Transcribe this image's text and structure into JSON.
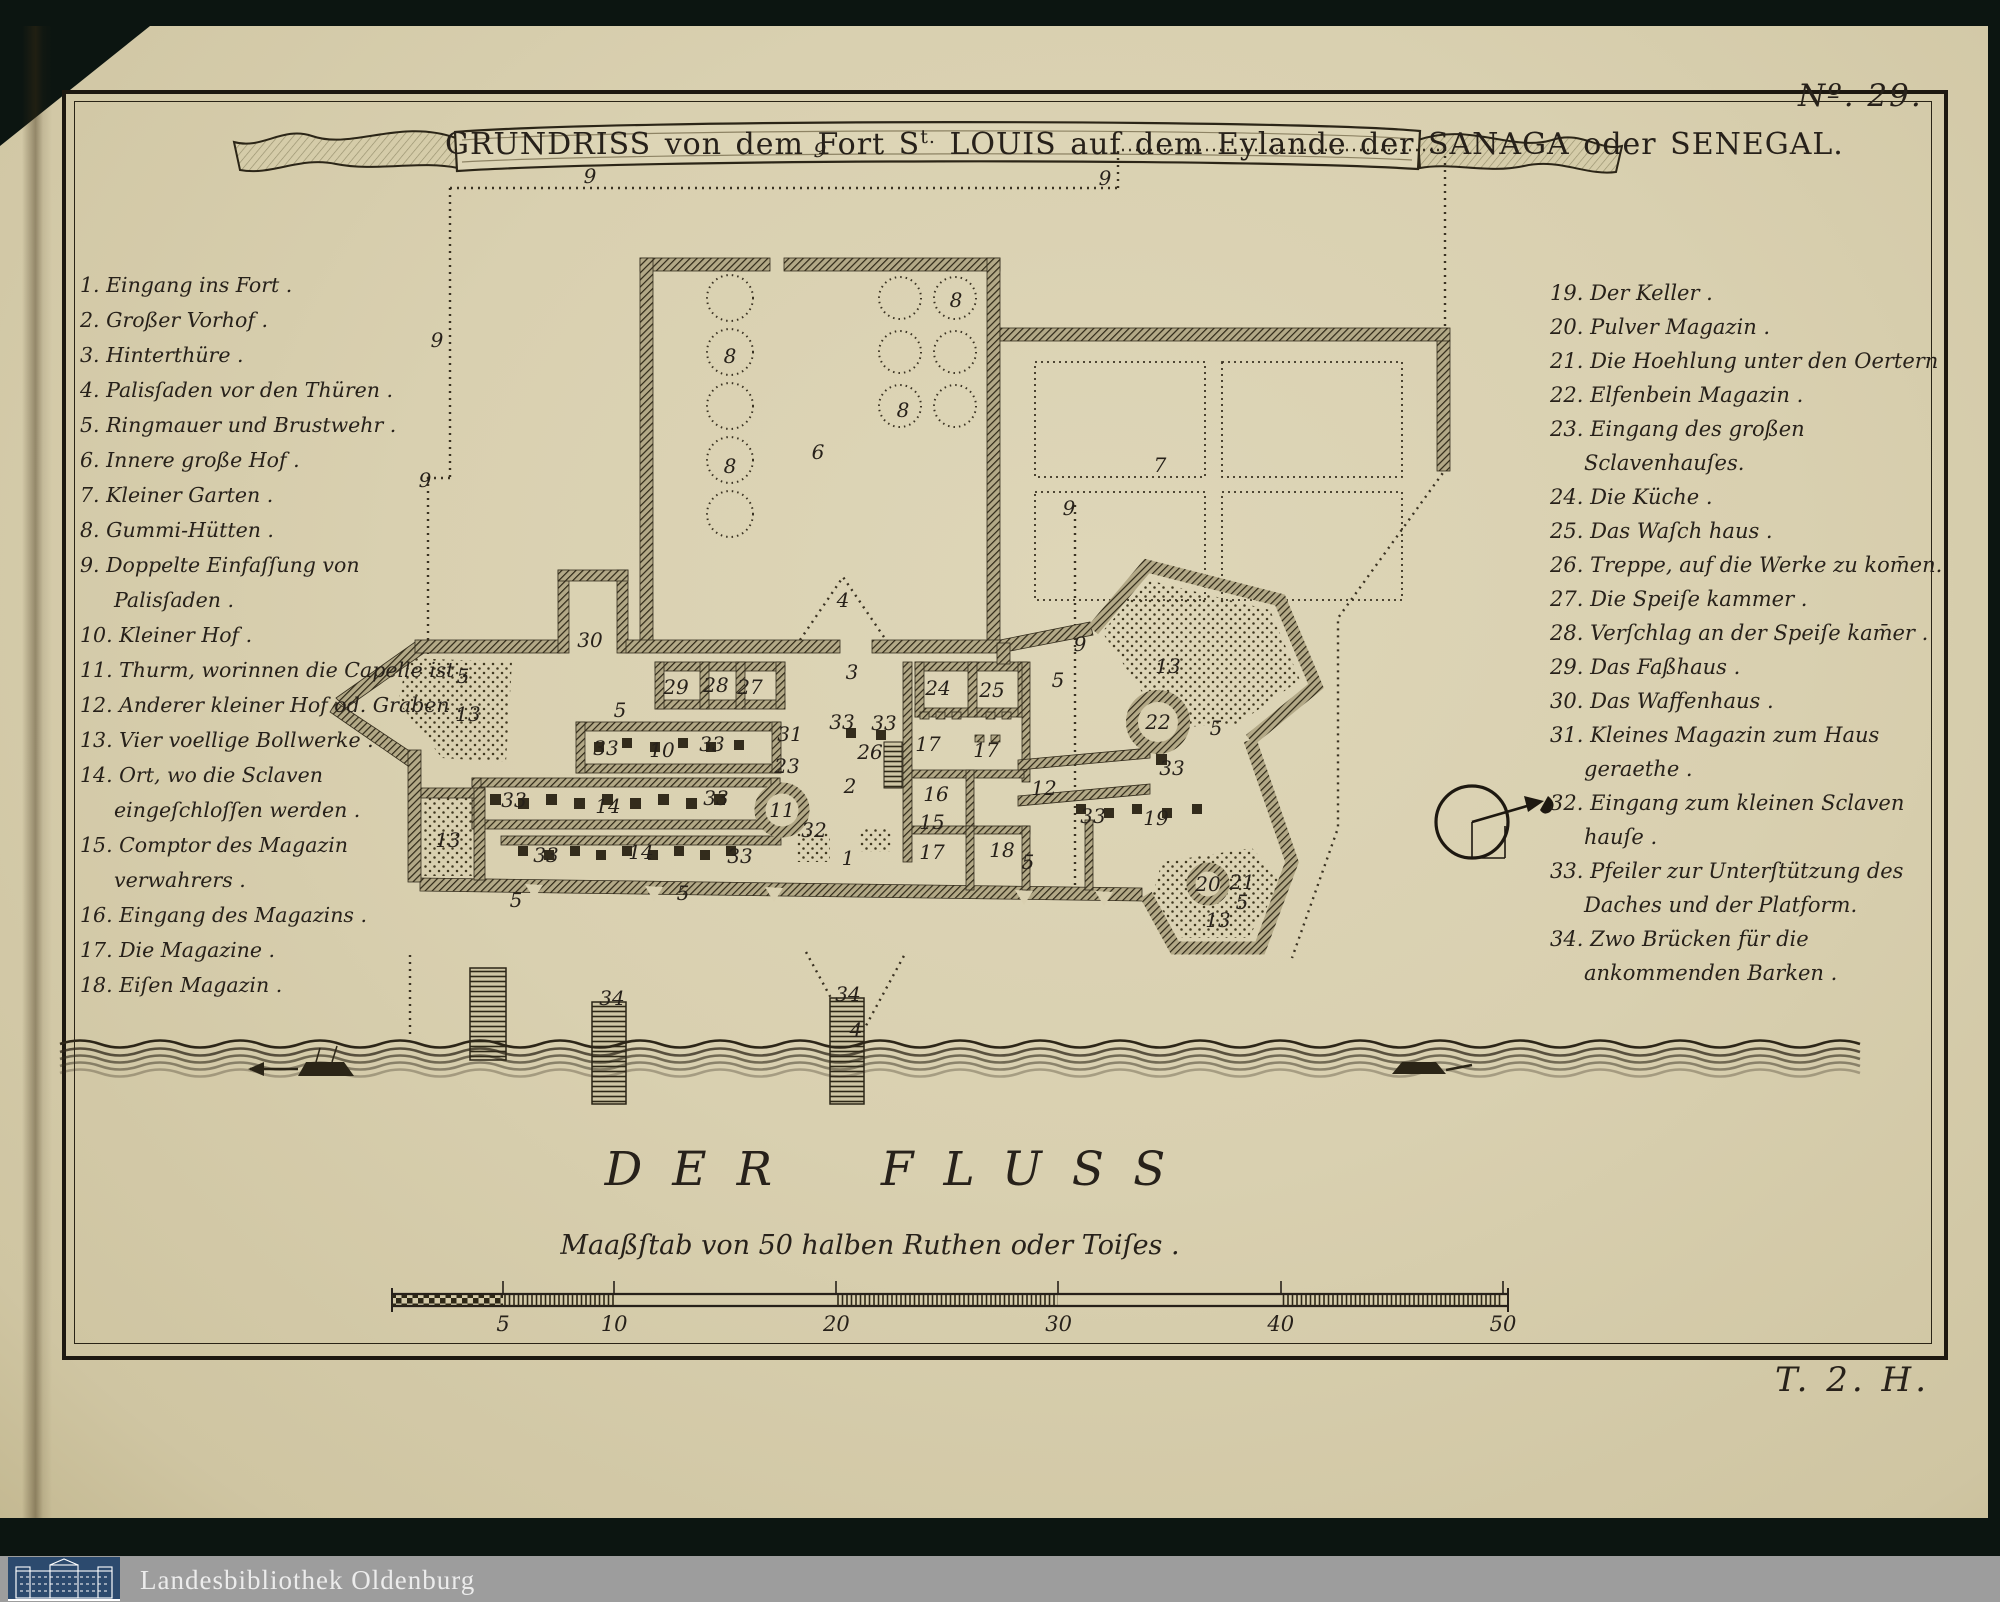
{
  "page": {
    "plate_number": "Nº. 29.",
    "plate_mark": "T. 2. H."
  },
  "title": {
    "part1": "GRUNDRISS von dem Fort S",
    "sup": "t.",
    "part2": "LOUIS auf dem Eylande der SANAGA oder SENEGAL."
  },
  "legend_left": [
    "1. Eingang ins Fort .",
    "2. Großer Vorhof .",
    "3. Hinterthüre .",
    "4. Palisſaden vor den Thüren .",
    "5. Ringmauer und Brustwehr .",
    "6. Innere große Hof .",
    "7. Kleiner Garten .",
    "8. Gummi-Hütten .",
    "9. Doppelte Einfaſſung von Palisſaden .",
    "10. Kleiner Hof .",
    "11. Thurm, worinnen die Capelle ist .",
    "12. Anderer kleiner Hof od. Graben .",
    "13. Vier voellige Bollwerke .",
    "14. Ort, wo die Sclaven eingeſchloſſen werden .",
    "15. Comptor des Magazin verwahrers .",
    "16. Eingang des Magazins .",
    "17. Die Magazine .",
    "18. Eiſen Magazin ."
  ],
  "legend_right": [
    "19. Der Keller .",
    "20. Pulver Magazin .",
    "21. Die Hoehlung unter den Oertern",
    "22. Elfenbein Magazin .",
    "23. Eingang des großen Sclavenhauſes.",
    "24. Die Küche .",
    "25. Das Waſch haus .",
    "26. Treppe, auf die Werke zu kom̄en.",
    "27. Die Speiſe kammer .",
    "28. Verſchlag an der Speiſe kam̄er .",
    "29. Das Faßhaus .",
    "30. Das Waffenhaus .",
    "31. Kleines Magazin zum Haus geraethe .",
    "32. Eingang zum kleinen Sclaven hauſe .",
    "33. Pfeiler zur Unterſtützung des Daches und der Platform.",
    "34. Zwo Brücken für die ankommenden Barken ."
  ],
  "river": {
    "label": "DER FLUSS"
  },
  "scale": {
    "caption": "Maaßſtab von 50 halben Ruthen oder Toiſes .",
    "ticks": [
      5,
      10,
      20,
      30,
      40,
      50
    ]
  },
  "footer": {
    "library": "Landesbibliothek Oldenburg"
  },
  "colors": {
    "paper": "#d9d0b0",
    "ink": "#27211a",
    "surround": "#0c1511",
    "footer_bar": "#9d9d9d",
    "logo_blue": "#2c4a6e"
  },
  "plan": {
    "labels": [
      {
        "t": "9",
        "x": 590,
        "y": 176
      },
      {
        "t": "9",
        "x": 820,
        "y": 150
      },
      {
        "t": "9",
        "x": 1105,
        "y": 178
      },
      {
        "t": "9",
        "x": 437,
        "y": 340
      },
      {
        "t": "9",
        "x": 425,
        "y": 480
      },
      {
        "t": "9",
        "x": 1069,
        "y": 508
      },
      {
        "t": "9",
        "x": 1080,
        "y": 644
      },
      {
        "t": "8",
        "x": 730,
        "y": 356
      },
      {
        "t": "8",
        "x": 730,
        "y": 466
      },
      {
        "t": "8",
        "x": 903,
        "y": 410
      },
      {
        "t": "8",
        "x": 956,
        "y": 300
      },
      {
        "t": "6",
        "x": 818,
        "y": 452
      },
      {
        "t": "7",
        "x": 1160,
        "y": 465
      },
      {
        "t": "4",
        "x": 843,
        "y": 600
      },
      {
        "t": "4",
        "x": 856,
        "y": 1030
      },
      {
        "t": "30",
        "x": 590,
        "y": 640
      },
      {
        "t": "5",
        "x": 463,
        "y": 676
      },
      {
        "t": "5",
        "x": 620,
        "y": 710
      },
      {
        "t": "5",
        "x": 683,
        "y": 893
      },
      {
        "t": "5",
        "x": 516,
        "y": 900
      },
      {
        "t": "5",
        "x": 1058,
        "y": 680
      },
      {
        "t": "5",
        "x": 1216,
        "y": 728
      },
      {
        "t": "5",
        "x": 1028,
        "y": 862
      },
      {
        "t": "5",
        "x": 1242,
        "y": 902
      },
      {
        "t": "29",
        "x": 676,
        "y": 687
      },
      {
        "t": "28",
        "x": 716,
        "y": 685
      },
      {
        "t": "27",
        "x": 750,
        "y": 687
      },
      {
        "t": "3",
        "x": 852,
        "y": 672
      },
      {
        "t": "24",
        "x": 938,
        "y": 688
      },
      {
        "t": "25",
        "x": 992,
        "y": 690
      },
      {
        "t": "13",
        "x": 468,
        "y": 714
      },
      {
        "t": "13",
        "x": 448,
        "y": 840
      },
      {
        "t": "13",
        "x": 1168,
        "y": 666
      },
      {
        "t": "13",
        "x": 1218,
        "y": 920
      },
      {
        "t": "33",
        "x": 842,
        "y": 722
      },
      {
        "t": "33",
        "x": 884,
        "y": 723
      },
      {
        "t": "33",
        "x": 606,
        "y": 748
      },
      {
        "t": "33",
        "x": 712,
        "y": 744
      },
      {
        "t": "33",
        "x": 514,
        "y": 800
      },
      {
        "t": "33",
        "x": 716,
        "y": 798
      },
      {
        "t": "33",
        "x": 546,
        "y": 855
      },
      {
        "t": "33",
        "x": 740,
        "y": 856
      },
      {
        "t": "33",
        "x": 1172,
        "y": 768
      },
      {
        "t": "33",
        "x": 1093,
        "y": 816
      },
      {
        "t": "10",
        "x": 662,
        "y": 750
      },
      {
        "t": "14",
        "x": 608,
        "y": 806
      },
      {
        "t": "14",
        "x": 641,
        "y": 852
      },
      {
        "t": "26",
        "x": 870,
        "y": 752
      },
      {
        "t": "31",
        "x": 790,
        "y": 734
      },
      {
        "t": "23",
        "x": 787,
        "y": 766
      },
      {
        "t": "17",
        "x": 928,
        "y": 744
      },
      {
        "t": "17",
        "x": 986,
        "y": 750
      },
      {
        "t": "17",
        "x": 932,
        "y": 852
      },
      {
        "t": "2",
        "x": 850,
        "y": 786
      },
      {
        "t": "16",
        "x": 936,
        "y": 794
      },
      {
        "t": "15",
        "x": 932,
        "y": 822
      },
      {
        "t": "11",
        "x": 782,
        "y": 810
      },
      {
        "t": "32",
        "x": 814,
        "y": 830
      },
      {
        "t": "1",
        "x": 848,
        "y": 858
      },
      {
        "t": "18",
        "x": 1002,
        "y": 850
      },
      {
        "t": "12",
        "x": 1044,
        "y": 788
      },
      {
        "t": "19",
        "x": 1156,
        "y": 818
      },
      {
        "t": "22",
        "x": 1158,
        "y": 722
      },
      {
        "t": "20",
        "x": 1208,
        "y": 884
      },
      {
        "t": "21",
        "x": 1242,
        "y": 882
      },
      {
        "t": "34",
        "x": 612,
        "y": 998
      },
      {
        "t": "34",
        "x": 848,
        "y": 994
      }
    ]
  }
}
